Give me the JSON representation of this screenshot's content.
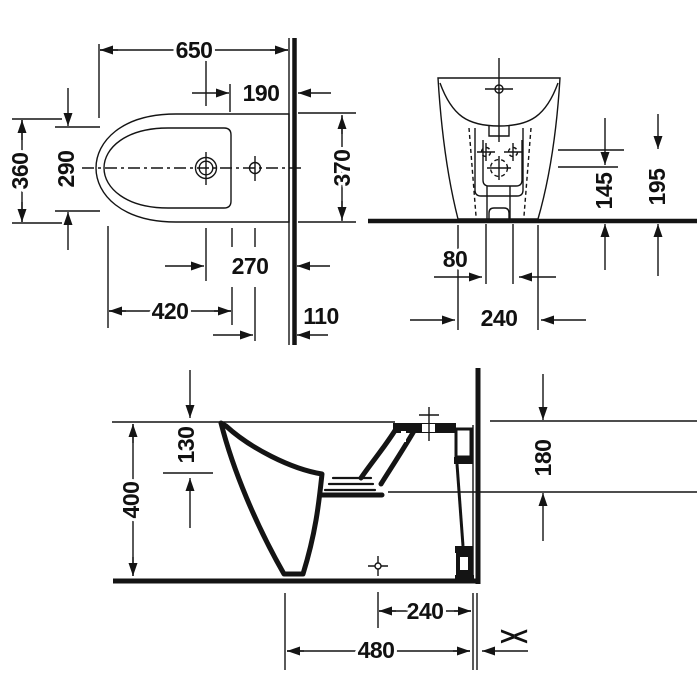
{
  "drawing": {
    "type": "technical-dimension-drawing",
    "subject": "floor-standing bidet",
    "background": "#ffffff",
    "line_color": "#141414"
  },
  "dimensions": {
    "plan": {
      "width": "650",
      "rim_to_wall": "190",
      "outer_depth": "360",
      "inner_depth": "290",
      "side_clearance": "370",
      "drain_to_wall": "270",
      "bowl_length": "420",
      "tap_to_wall": "110"
    },
    "front": {
      "fixing_height": "145",
      "rim_height": "195",
      "hole_spacing": "80",
      "base_width": "240"
    },
    "side": {
      "rim_depth": "130",
      "height": "400",
      "outlet_drop": "180",
      "base_depth": "240",
      "total_depth": "480"
    }
  },
  "symbols": {
    "finished_wall_mark": "><"
  }
}
